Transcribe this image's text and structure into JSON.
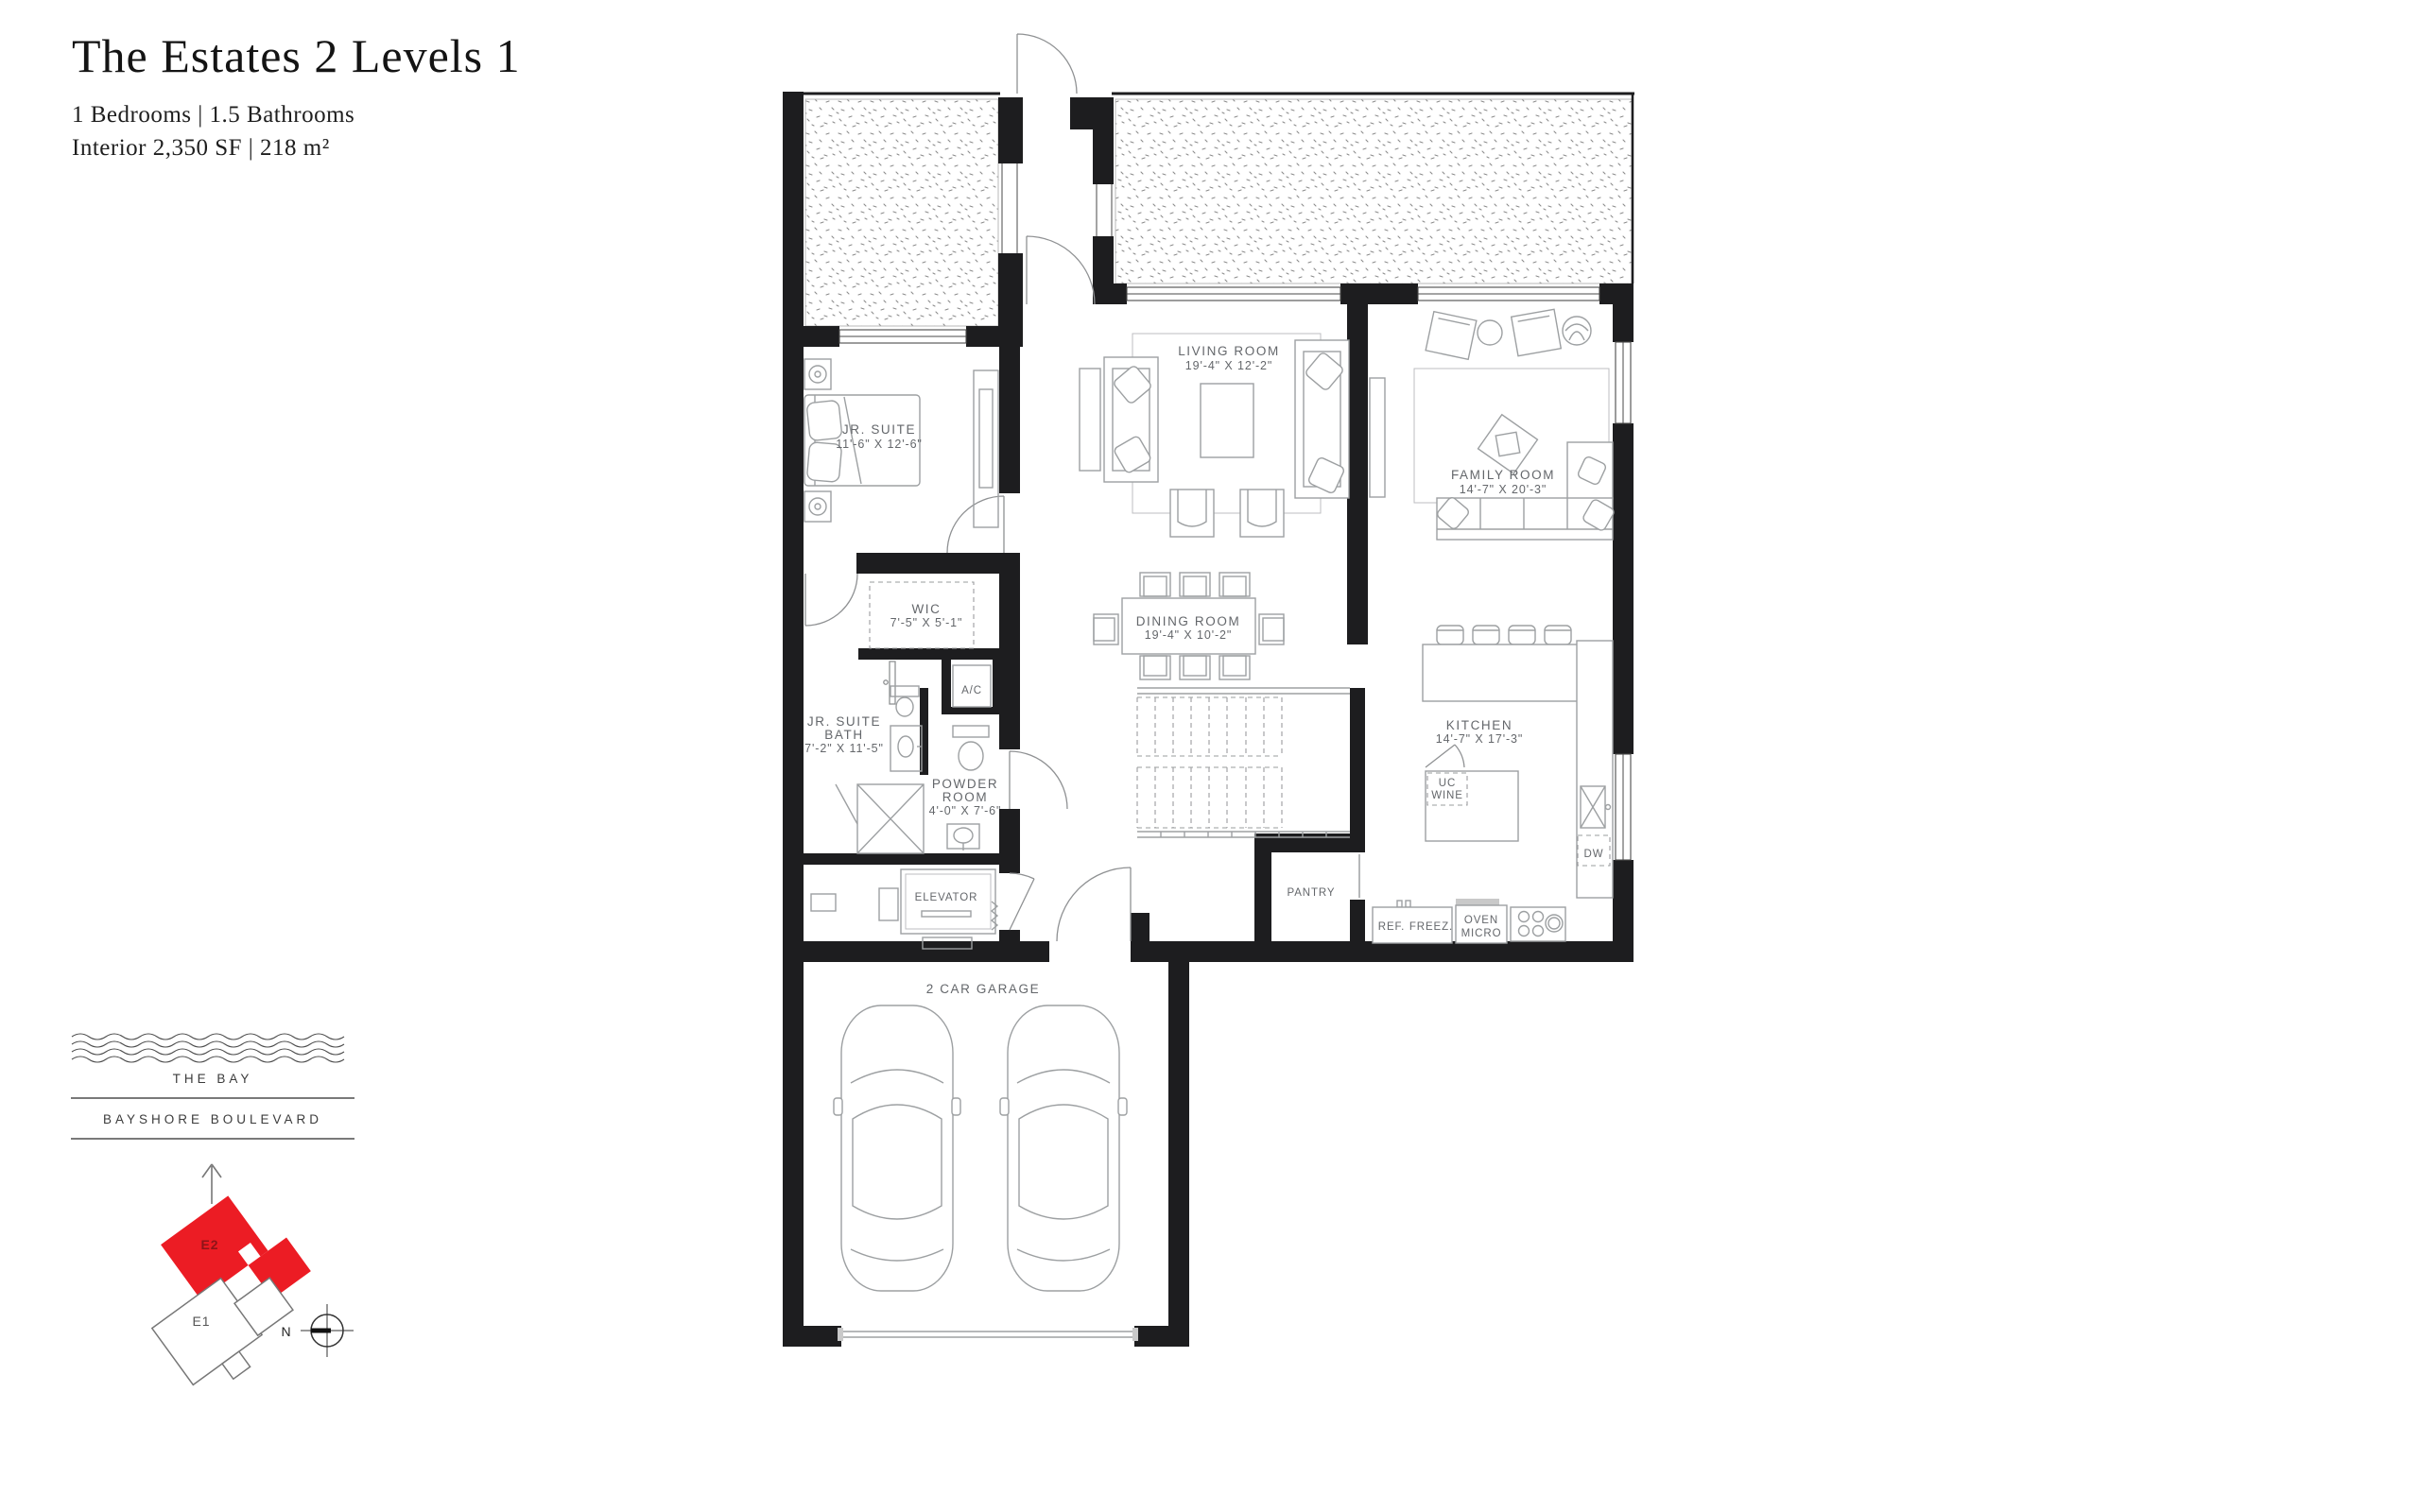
{
  "header": {
    "title": "The Estates 2 Levels 1",
    "specs": "1 Bedrooms  |  1.5 Bathrooms",
    "interior": "Interior  2,350 SF  |  218 m²"
  },
  "plan": {
    "rooms": {
      "jr_suite": {
        "name": "JR. SUITE",
        "dims": "11'-6\" X 12'-6\""
      },
      "living": {
        "name": "LIVING ROOM",
        "dims": "19'-4\" X 12'-2\""
      },
      "family": {
        "name": "FAMILY ROOM",
        "dims": "14'-7\" X 20'-3\""
      },
      "wic": {
        "name": "WIC",
        "dims": "7'-5\" X 5'-1\""
      },
      "dining": {
        "name": "DINING ROOM",
        "dims": "19'-4\" X 10'-2\""
      },
      "jr_bath": {
        "name1": "JR. SUITE",
        "name2": "BATH",
        "dims": "7'-2\" X 11'-5\""
      },
      "powder": {
        "name1": "POWDER",
        "name2": "ROOM",
        "dims": "4'-0\" X 7'-6\""
      },
      "kitchen": {
        "name": "KITCHEN",
        "dims": "14'-7\" X 17'-3\""
      },
      "garage": {
        "name": "2 CAR GARAGE"
      }
    },
    "fixtures": {
      "ac": "A/C",
      "elevator": "ELEVATOR",
      "pantry": "PANTRY",
      "uc_wine_1": "UC",
      "uc_wine_2": "WINE",
      "dw": "DW",
      "ref": "REF.",
      "freez": "FREEZ.",
      "oven_1": "OVEN",
      "oven_2": "MICRO"
    }
  },
  "locator": {
    "bay": "THE BAY",
    "boulevard": "BAYSHORE BOULEVARD",
    "unit_highlight": "E2",
    "unit_other": "E1",
    "compass_north": "N",
    "highlight_color": "#ec1c24"
  }
}
